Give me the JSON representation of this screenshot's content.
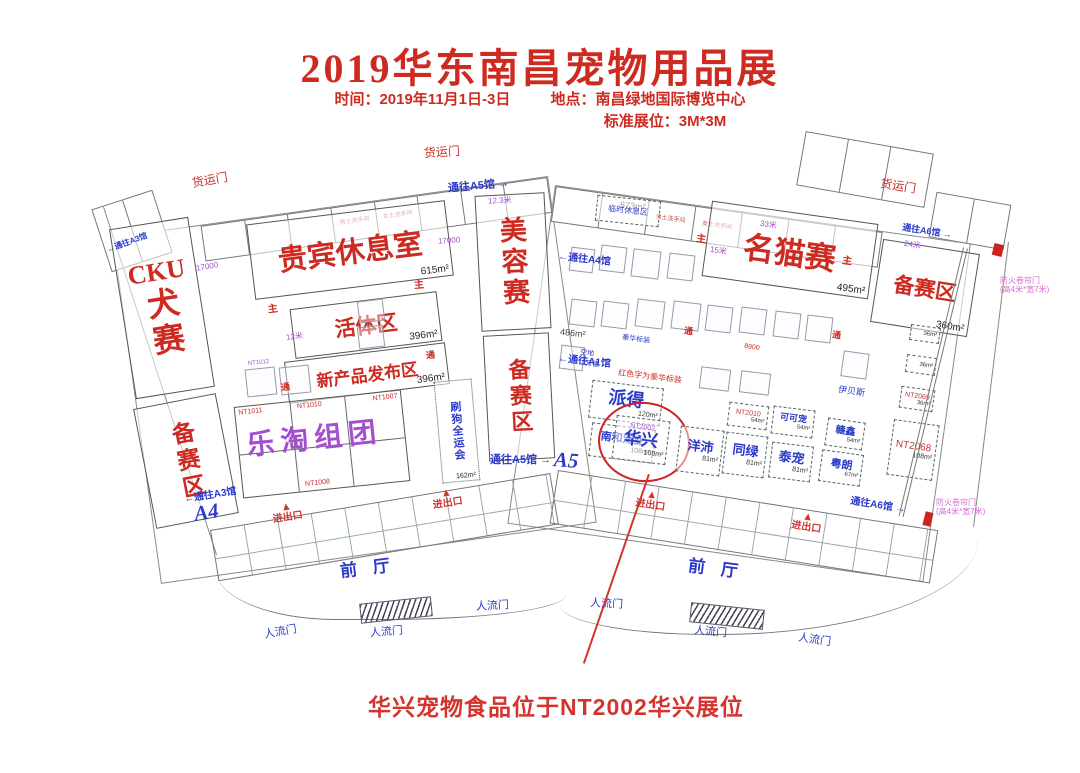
{
  "header": {
    "title": "2019华东南昌宠物用品展",
    "time": "时间：2019年11月1日-3日",
    "location": "地点：南昌绿地国际博览中心",
    "spec": "标准展位：3M*3M"
  },
  "annotation": {
    "text": "华兴宠物食品位于NT2002华兴展位"
  },
  "zones": {
    "cku_latin": "CKU",
    "cku_cn": "犬赛",
    "cku_prep": "备赛区",
    "vip": "贵宾休息室",
    "vip_area": "615m²",
    "live": "活体区",
    "live_area": "396m²",
    "newprod": "新产品发布区",
    "newprod_area": "396m²",
    "letao": "乐淘组团",
    "nt1011": "NT1011",
    "nt1010": "NT1010",
    "nt1008": "NT1008",
    "nt1007": "NT1007",
    "nt1012": "NT1012",
    "doggames": "刷狗全运会",
    "doggames_area": "162m²",
    "beauty": "美容赛",
    "beauty_prep": "备赛区",
    "f673": "673m²",
    "f486": "486m²",
    "catshow": "名猫赛",
    "catshow_area": "495m²",
    "prep2": "备赛区",
    "prep2_area": "360m²",
    "rest": "临时休息区",
    "front": "前厅"
  },
  "booths": {
    "paide": {
      "name": "派得",
      "area": "120m²"
    },
    "nanhe": {
      "name": "南和宠业",
      "area": "108m²"
    },
    "huaxing": {
      "id": "NT2002",
      "name": "华兴",
      "area": "108m²"
    },
    "yangpei": {
      "name": "洋沛",
      "area": "81m²"
    },
    "tonglv": {
      "name": "同绿",
      "area": "81m²"
    },
    "taichong": {
      "name": "泰宠",
      "area": "81m²"
    },
    "nt2010": {
      "id": "NT2010",
      "area": "54m²"
    },
    "kekechong": {
      "name": "可可宠",
      "area": "54m²"
    },
    "ganxin": {
      "name": "赣鑫",
      "area": "54m²"
    },
    "yuelang": {
      "name": "粤朗",
      "area": "67m²"
    },
    "nt2068": {
      "id": "NT2068",
      "area": "108m²"
    },
    "nt2069": {
      "id": "NT2069",
      "area": "36m²"
    },
    "b36": {
      "area": "36m²"
    },
    "wande": "万德",
    "kongdi": "空地",
    "haohua": "豪华标装",
    "yibeisi": "伊贝斯",
    "legend": "红色字为豪华标装"
  },
  "doors": {
    "cargo": "货运门",
    "exit": "进出口",
    "people": "人流门",
    "to_a3": "通往A3馆",
    "to_a4": "通往A4馆",
    "to_a1": "通往A1馆",
    "to_a5": "通往A5馆",
    "to_a6": "通往A6馆",
    "a4": "A4",
    "a5": "A5",
    "fire_line1": "防火卷帘门",
    "fire_line2": "(高4米*宽7米)",
    "men": "男士洗手间",
    "women": "女士洗手间",
    "main": "主",
    "aisle": "通"
  },
  "dims": {
    "d17000": "17000",
    "d123": "12.3米",
    "d33": "33米",
    "d24": "24米",
    "d15": "15米",
    "d12": "12米",
    "d8900": "8900"
  }
}
